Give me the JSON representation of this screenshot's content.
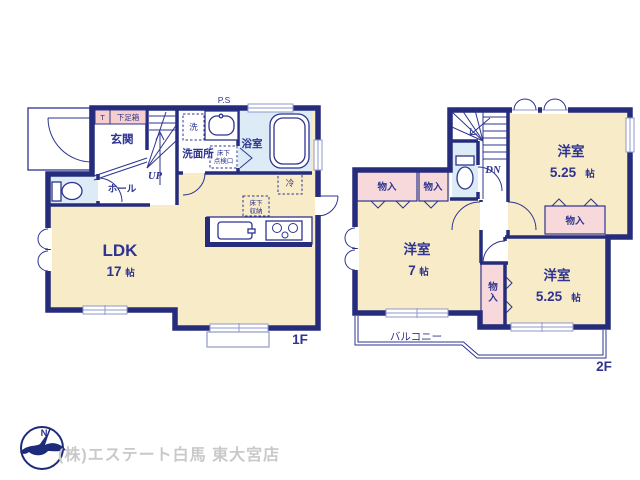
{
  "document_type": "floor-plan",
  "colors": {
    "wall": "#262c7c",
    "label_text": "#2e3490",
    "room_floor": "#f8ebc7",
    "closet_fill": "#f7d9db",
    "wet_area_fill": "#dcebf5",
    "window_line": "#8f9ac9",
    "footer_text": "#c9c9c9"
  },
  "floor1": {
    "floor_label": "1F",
    "genkan": "玄関",
    "shoe_t": "T",
    "shoe_box": "下足箱",
    "ps": "P.S",
    "wash": "洗",
    "senmenjo": "洗面所",
    "tenken_l1": "床下",
    "tenken_l2": "点検口",
    "bath": "浴室",
    "up": "UP",
    "hall": "ホール",
    "fridge": "冷",
    "shuno_l1": "床下",
    "shuno_l2": "収納",
    "ldk": "LDK",
    "ldk_size": "17",
    "jou": "帖"
  },
  "floor2": {
    "floor_label": "2F",
    "dn": "DN",
    "closet": "物入",
    "closet_v1": "物",
    "closet_v2": "入",
    "room_top": "洋室",
    "room_top_size": "5.25",
    "room_west": "洋室",
    "room_west_size": "7",
    "room_south": "洋室",
    "room_south_size": "5.25",
    "jou": "帖",
    "balcony": "バルコニー"
  },
  "footer": {
    "company": "(株)エステート白馬 東大宮店",
    "compass_n": "N"
  }
}
